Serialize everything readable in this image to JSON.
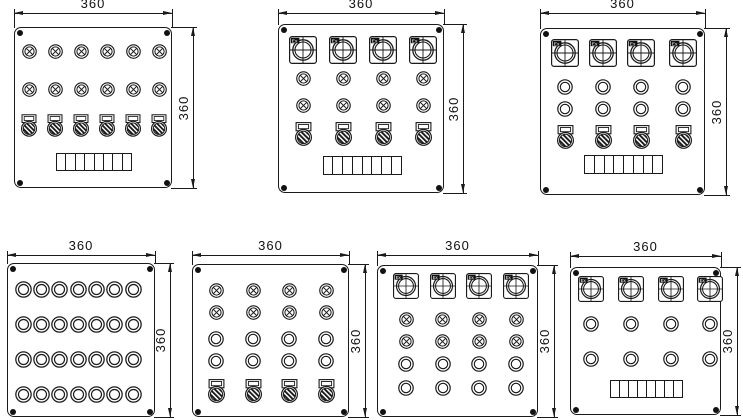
{
  "meta": {
    "type": "technical-drawing",
    "description": "Seven explosion-proof control panel face layout drawings"
  },
  "style": {
    "line_color": "#1a1a1a",
    "screw_color": "#111111",
    "background": "#ffffff"
  },
  "dimensions": {
    "width_label": "360",
    "height_label": "360"
  },
  "elements": {
    "ex_label": "Ex"
  },
  "panels": [
    {
      "name": "panel-12-lamps-6-switches",
      "box": [
        14,
        27,
        158,
        161
      ],
      "dim_top_y": 13,
      "dim_right_x": 193,
      "cols": [
        14,
        40,
        66,
        92,
        118,
        144
      ],
      "rows": [
        {
          "type": "lamp",
          "y": 23,
          "d": 15
        },
        {
          "type": "lamp",
          "y": 61,
          "d": 15
        },
        {
          "type": "switch",
          "y": 97,
          "w": 16,
          "h": 23
        },
        {
          "type": "strip",
          "y": 134,
          "w": 76,
          "h": 18,
          "cells": 8
        }
      ]
    },
    {
      "name": "panel-4-meters-8-lamps-4-switches",
      "box": [
        278,
        24,
        166,
        169
      ],
      "dim_top_y": 13,
      "dim_right_x": 463,
      "cols": [
        24,
        64,
        104,
        144
      ],
      "rows": [
        {
          "type": "exmeter",
          "y": 25,
          "d": 28
        },
        {
          "type": "lamp",
          "y": 53,
          "d": 15
        },
        {
          "type": "lamp",
          "y": 80,
          "d": 15
        },
        {
          "type": "switch",
          "y": 109,
          "w": 17,
          "h": 24
        },
        {
          "type": "strip",
          "y": 140,
          "w": 79,
          "h": 19,
          "cells": 8
        }
      ]
    },
    {
      "name": "panel-4-meters-8-buttons-4-switches",
      "box": [
        540,
        28,
        165,
        167
      ],
      "dim_top_y": 13,
      "dim_right_x": 726,
      "cols": [
        24,
        62,
        100,
        142
      ],
      "rows": [
        {
          "type": "exmeter",
          "y": 24,
          "d": 28
        },
        {
          "type": "button",
          "y": 58,
          "d": 16
        },
        {
          "type": "button",
          "y": 80,
          "d": 16
        },
        {
          "type": "switch",
          "y": 108,
          "w": 17,
          "h": 24
        },
        {
          "type": "strip",
          "y": 135,
          "w": 79,
          "h": 19,
          "cells": 8
        }
      ]
    },
    {
      "name": "panel-28-buttons",
      "box": [
        7,
        263,
        148,
        154
      ],
      "dim_top_y": 255,
      "dim_right_x": 170,
      "cols": [
        15,
        33.3,
        51.7,
        70,
        88.3,
        106.7,
        125
      ],
      "rows": [
        {
          "type": "button",
          "y": 25,
          "d": 17
        },
        {
          "type": "button",
          "y": 60,
          "d": 17
        },
        {
          "type": "button",
          "y": 95,
          "d": 17
        },
        {
          "type": "button",
          "y": 130,
          "d": 17
        }
      ]
    },
    {
      "name": "panel-8-lamps-8-buttons-4-switches",
      "box": [
        192,
        264,
        157,
        153
      ],
      "dim_top_y": 255,
      "dim_right_x": 365,
      "cols": [
        23,
        60,
        96,
        133
      ],
      "rows": [
        {
          "type": "lamp",
          "y": 25,
          "d": 15
        },
        {
          "type": "lamp",
          "y": 47,
          "d": 15
        },
        {
          "type": "button",
          "y": 74,
          "d": 16
        },
        {
          "type": "button",
          "y": 96,
          "d": 16
        },
        {
          "type": "switch",
          "y": 126,
          "w": 17,
          "h": 24
        }
      ]
    },
    {
      "name": "panel-4-meters-8-lamps-8-buttons",
      "box": [
        377,
        265,
        161,
        152
      ],
      "dim_top_y": 255,
      "dim_right_x": 554,
      "cols": [
        28,
        64.7,
        101.3,
        138
      ],
      "rows": [
        {
          "type": "exmeter",
          "y": 20,
          "d": 26
        },
        {
          "type": "lamp",
          "y": 53,
          "d": 15
        },
        {
          "type": "lamp",
          "y": 75,
          "d": 15
        },
        {
          "type": "button",
          "y": 98,
          "d": 16
        },
        {
          "type": "button",
          "y": 122,
          "d": 16
        }
      ]
    },
    {
      "name": "panel-4-meters-8-buttons-strip",
      "box": [
        570,
        267,
        151,
        148
      ],
      "dim_top_y": 256,
      "dim_right_x": 737,
      "cols": [
        20,
        60,
        100,
        139
      ],
      "rows": [
        {
          "type": "exmeter",
          "y": 21,
          "d": 26
        },
        {
          "type": "button",
          "y": 56,
          "d": 16
        },
        {
          "type": "button",
          "y": 91,
          "d": 16
        },
        {
          "type": "strip",
          "y": 121,
          "w": 73,
          "h": 18,
          "cells": 8
        }
      ]
    }
  ]
}
